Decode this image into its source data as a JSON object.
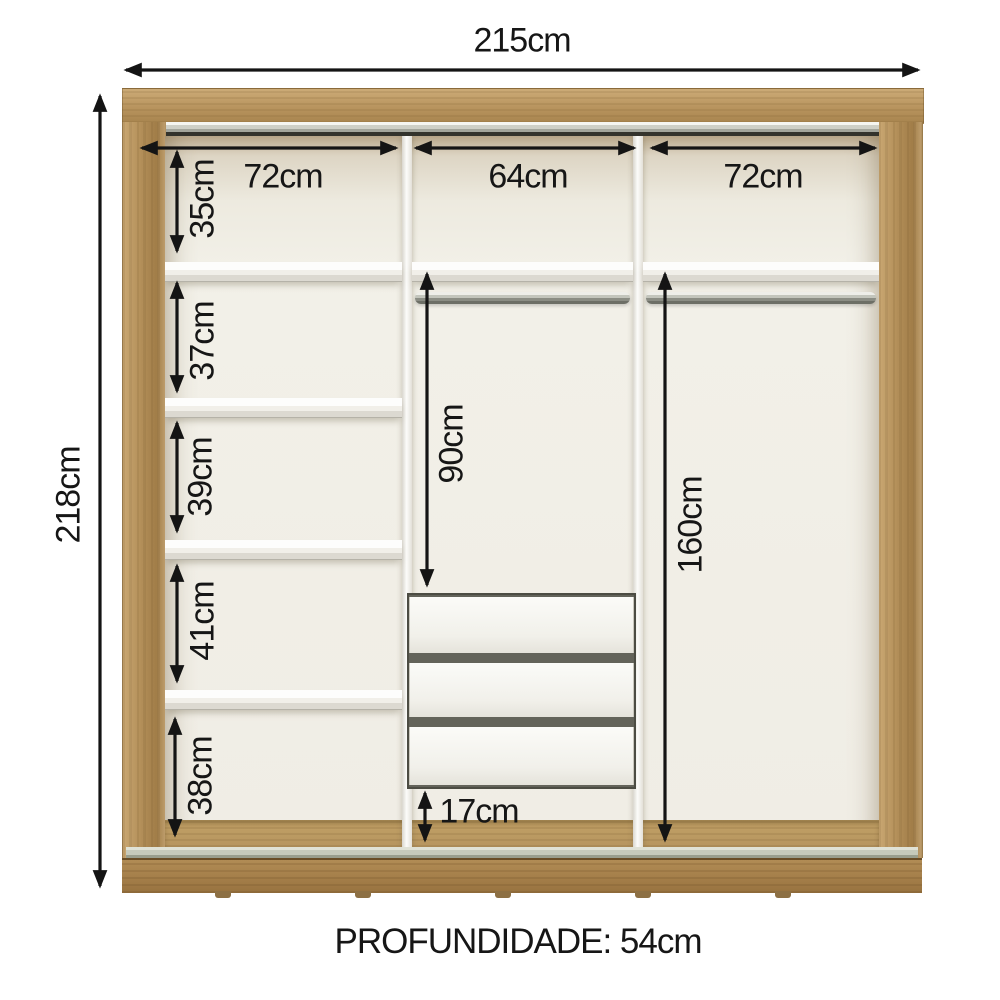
{
  "diagram": {
    "overall": {
      "width_label": "215cm",
      "height_label": "218cm"
    },
    "depth_label": "PROFUNDIDADE: 54cm",
    "sections": {
      "left_width": "72cm",
      "middle_width": "64cm",
      "right_width": "72cm"
    },
    "left_column_gaps": {
      "gap_1": "35cm",
      "gap_2": "37cm",
      "gap_3": "39cm",
      "gap_4": "41cm",
      "gap_5": "38cm"
    },
    "middle_column": {
      "hanging_space": "90cm",
      "bottom_clearance": "17cm",
      "drawer_count": 3
    },
    "right_column": {
      "hanging_space": "160cm"
    },
    "colors": {
      "wood": "#b4905a",
      "interior_back": "#f0ede5",
      "dimension_text": "#161616",
      "rail_dark": "#33332c"
    }
  }
}
